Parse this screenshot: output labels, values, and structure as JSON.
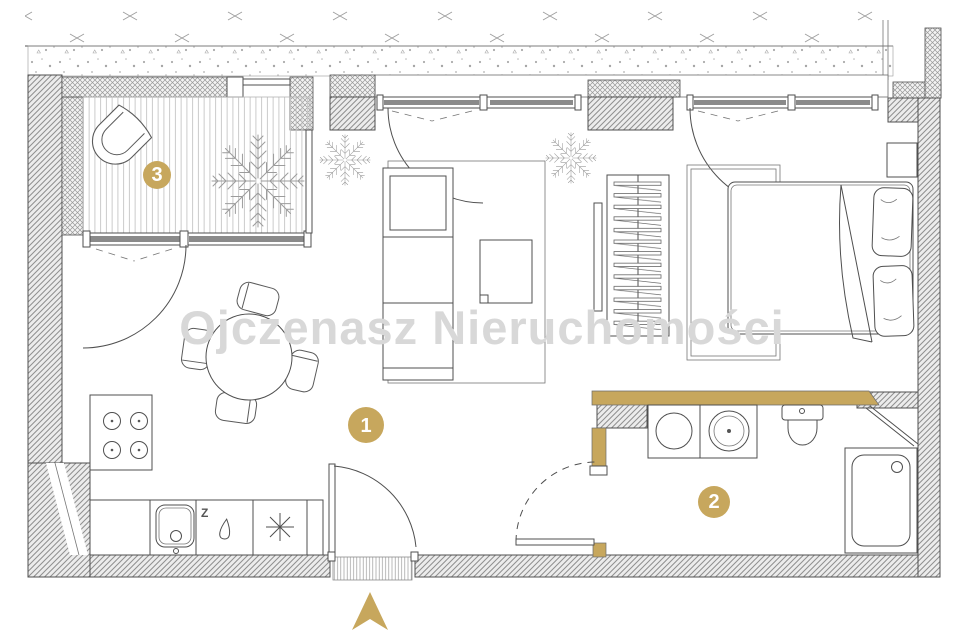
{
  "watermark": {
    "text": "Ojczenasz Nieruchomości"
  },
  "markers": [
    {
      "label": "1"
    },
    {
      "label": "2"
    },
    {
      "label": "3"
    }
  ],
  "kitchen": {
    "dishwasher_label": "Z"
  },
  "compass": {
    "direction_label": ""
  },
  "colors": {
    "accent_gold": "#C7A75D",
    "watermark_gray": "#D8D8D8",
    "drawing_line": "#4F4F4F",
    "window_glass_gray": "#8A8A8A",
    "wall_hatch_bg": "#ECECEC"
  },
  "icons": [
    "north-arrow-icon",
    "plant-icon",
    "armchair-icon",
    "sofa-icon",
    "coffee-table-icon",
    "dining-table-icon",
    "dining-chair-icon",
    "stove-icon",
    "kitchen-sink-icon",
    "dishwasher-drop-icon",
    "freezer-asterisk-icon",
    "wardrobe-icon",
    "bed-icon",
    "pillow-icon",
    "nightstand-icon",
    "washing-machine-icon",
    "bathroom-sink-icon",
    "toilet-icon",
    "shower-icon",
    "door-swing-icon",
    "window-icon"
  ]
}
